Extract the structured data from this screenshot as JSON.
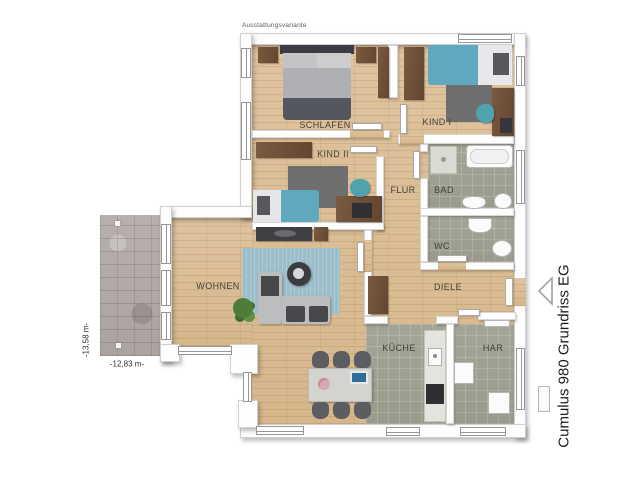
{
  "meta": {
    "variant_label": "Ausstattungsvariante",
    "plan_title": "Cumulus 980 Grundriss EG"
  },
  "dimensions": {
    "height_label": "-13,58 m-",
    "width_label": "-12,83 m-"
  },
  "rooms": {
    "schlafen": "SCHLAFEN",
    "kind1": "KIND I",
    "kind2": "KIND II",
    "flur": "FLUR",
    "bad": "BAD",
    "wc": "WC",
    "wohnen": "WOHNEN",
    "diele": "DIELE",
    "kueche": "KÜCHE",
    "har": "HAR"
  },
  "colors": {
    "wood_floor": "#dcc09a",
    "tile_floor": "#a0a094",
    "terrace_stone": "#b5aeab",
    "teal_accent": "#5fa8bd",
    "blue_rug": "#9cbecb",
    "gray_rug": "#707070",
    "dark_wood": "#6f523c",
    "sofa_gray": "#bcbdbf",
    "wall_white": "#ffffff"
  },
  "markers": {
    "entrance_arrow": "entrance-arrow",
    "terrace_point_top": "terrace-marker",
    "terrace_point_bottom": "terrace-marker"
  }
}
